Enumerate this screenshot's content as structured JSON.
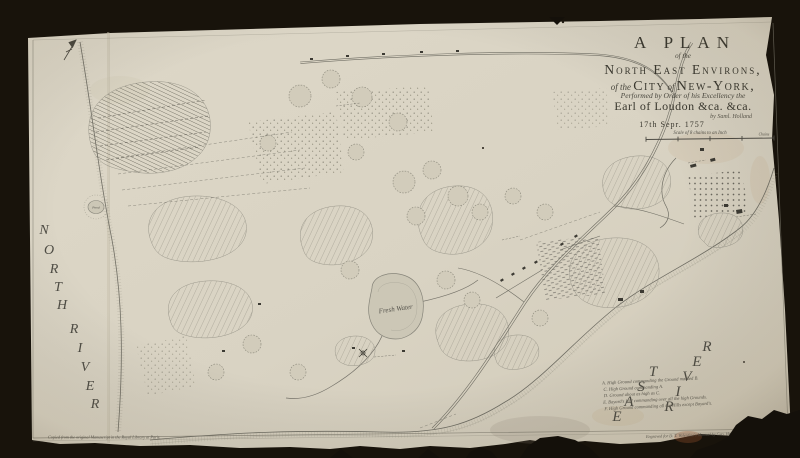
{
  "map": {
    "title_block": {
      "line1": "A PLAN",
      "line2": "of the",
      "line3": "North East Environs,",
      "line4a": "of the ",
      "line4b": "City",
      "line4c": " of ",
      "line4d": "New-York,",
      "line5": "Performed by Order of his Excellency the",
      "line6": "Earl of Loudon &ca. &ca.",
      "line7": "by Saml. Holland",
      "line8": "17th Sepr. 1757",
      "scale_caption": "Scale of 8 chains to an Inch",
      "scale_unit": "Chains"
    },
    "water_labels": {
      "north_river": "NORTH RIVER",
      "east_river": "EAST RIVER"
    },
    "place_labels": {
      "fresh_water": "Fresh Water",
      "pond": "Pond"
    },
    "legend": {
      "lines": [
        "A. High Ground commanding the Ground marked B.",
        "C. High Ground commanding A.",
        "D. Ground about as high as C.",
        "E. Bayard's Hill commanding over all the high Grounds.",
        "F. High Ground commanding all the Hills except Bayard's."
      ]
    },
    "credits": {
      "left": "Copied from the original Manuscript in the Royal Library at Paris.",
      "right": "Engraved for D. T. Valentine's Manual by Geo. Hayward, New York."
    },
    "colors": {
      "backdrop": "#14100a",
      "paper": "#d9d3c3",
      "ink": "#3a382f",
      "fine_line": "#6f6d63",
      "stain_red": "#a85a33"
    }
  }
}
